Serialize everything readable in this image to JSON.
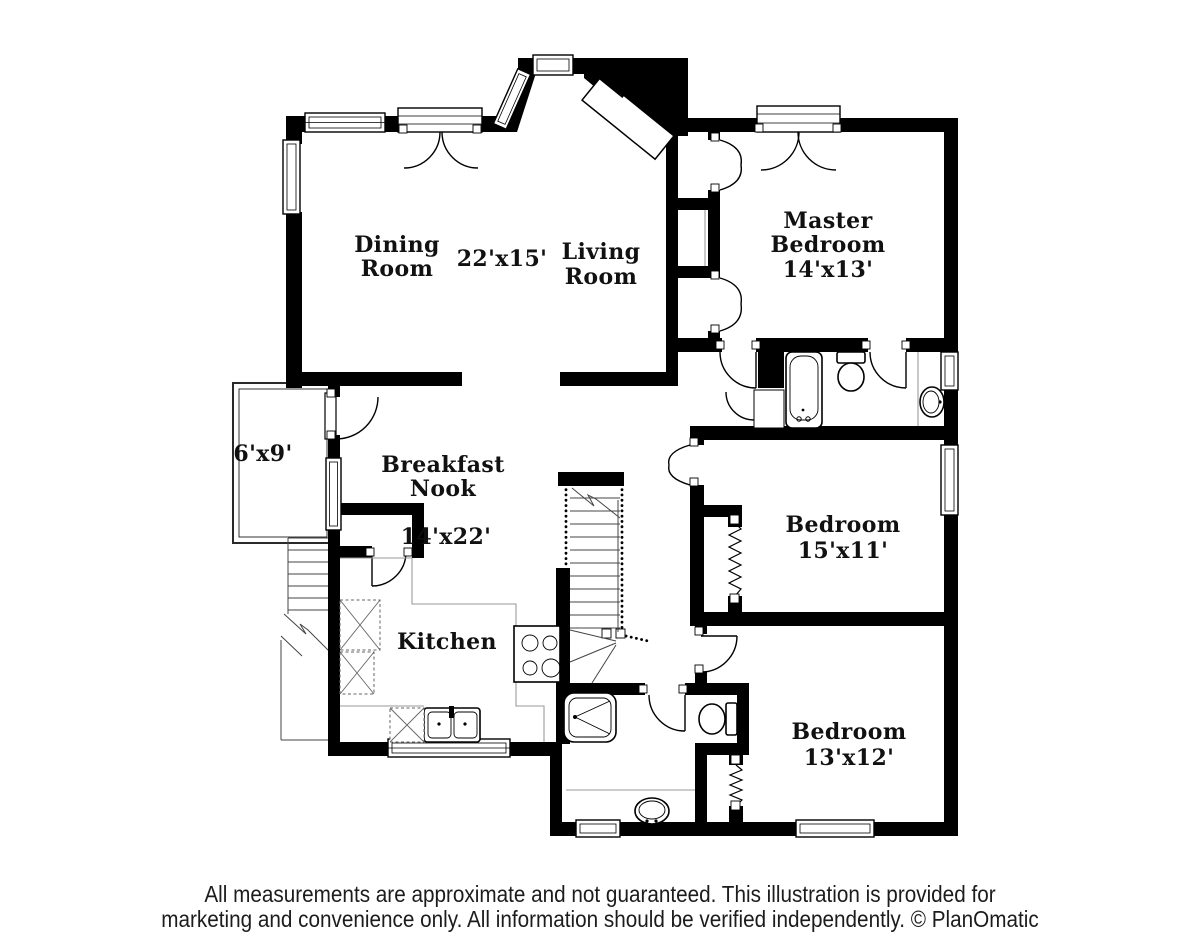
{
  "rooms": {
    "dining": {
      "line1": "Dining",
      "line2": "Room"
    },
    "dining_living_dims": "22'x15'",
    "living": {
      "line1": "Living",
      "line2": "Room"
    },
    "master": {
      "line1": "Master",
      "line2": "Bedroom",
      "dims": "14'x13'"
    },
    "deck": {
      "dims": "6'x9'"
    },
    "nook": {
      "line1": "Breakfast",
      "line2": "Nook",
      "dims": "14'x22'"
    },
    "kitchen": {
      "name": "Kitchen"
    },
    "bedroom1": {
      "name": "Bedroom",
      "dims": "15'x11'"
    },
    "bedroom2": {
      "name": "Bedroom",
      "dims": "13'x12'"
    }
  },
  "fixtures": [
    "bathtub",
    "toilet",
    "vanity-sink",
    "shower",
    "range-stove",
    "kitchen-sink",
    "base-cabinets",
    "pantry-closet",
    "linen-closet",
    "staircase",
    "deck-stairs",
    "bifold-closet",
    "front-door",
    "french-doors"
  ],
  "colors": {
    "wall": "#000000",
    "floor": "#ffffff",
    "label": "#111111",
    "counter": "#9a9a9a",
    "footer_text": "#1c1c1c"
  },
  "footer": {
    "line1": "All measurements are approximate and not guaranteed. This illustration is provided for",
    "line2": "marketing and convenience only. All information should be verified independently. © PlanOmatic"
  }
}
